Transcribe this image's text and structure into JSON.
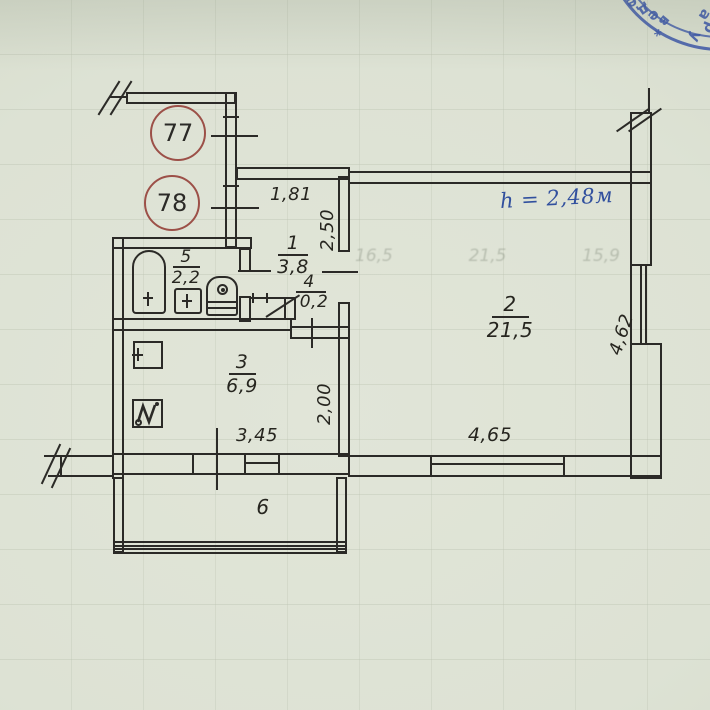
{
  "palette": {
    "paper": "#dde2d4",
    "ink": "#2b2a27",
    "red_circle": "#9c5048",
    "stamp_blue": "#3854a8"
  },
  "apartment_numbers": {
    "top": "77",
    "bottom": "78"
  },
  "rooms": {
    "r1": {
      "num": "1",
      "area": "3,8"
    },
    "r2": {
      "num": "2",
      "area": "21,5"
    },
    "r3": {
      "num": "3",
      "area": "6,9"
    },
    "r4": {
      "num": "4",
      "area": "0,2"
    },
    "r5": {
      "num": "5",
      "area": "2,2"
    },
    "r6": {
      "num": "6"
    }
  },
  "dimensions": {
    "hall_width": "1,81",
    "hall_depth": "2,50",
    "ceiling_height": "h = 2,48м",
    "kitchen_depth": "2,00",
    "balcony_width": "3,45",
    "room2_width": "4,65",
    "room2_depth": "4,62"
  },
  "ghost_numbers": [
    "16,5",
    "21,5",
    "15,9"
  ],
  "stamp": {
    "letters": [
      "е",
      "д",
      "е",
      "в",
      "*",
      "у",
      "а",
      "р"
    ]
  }
}
